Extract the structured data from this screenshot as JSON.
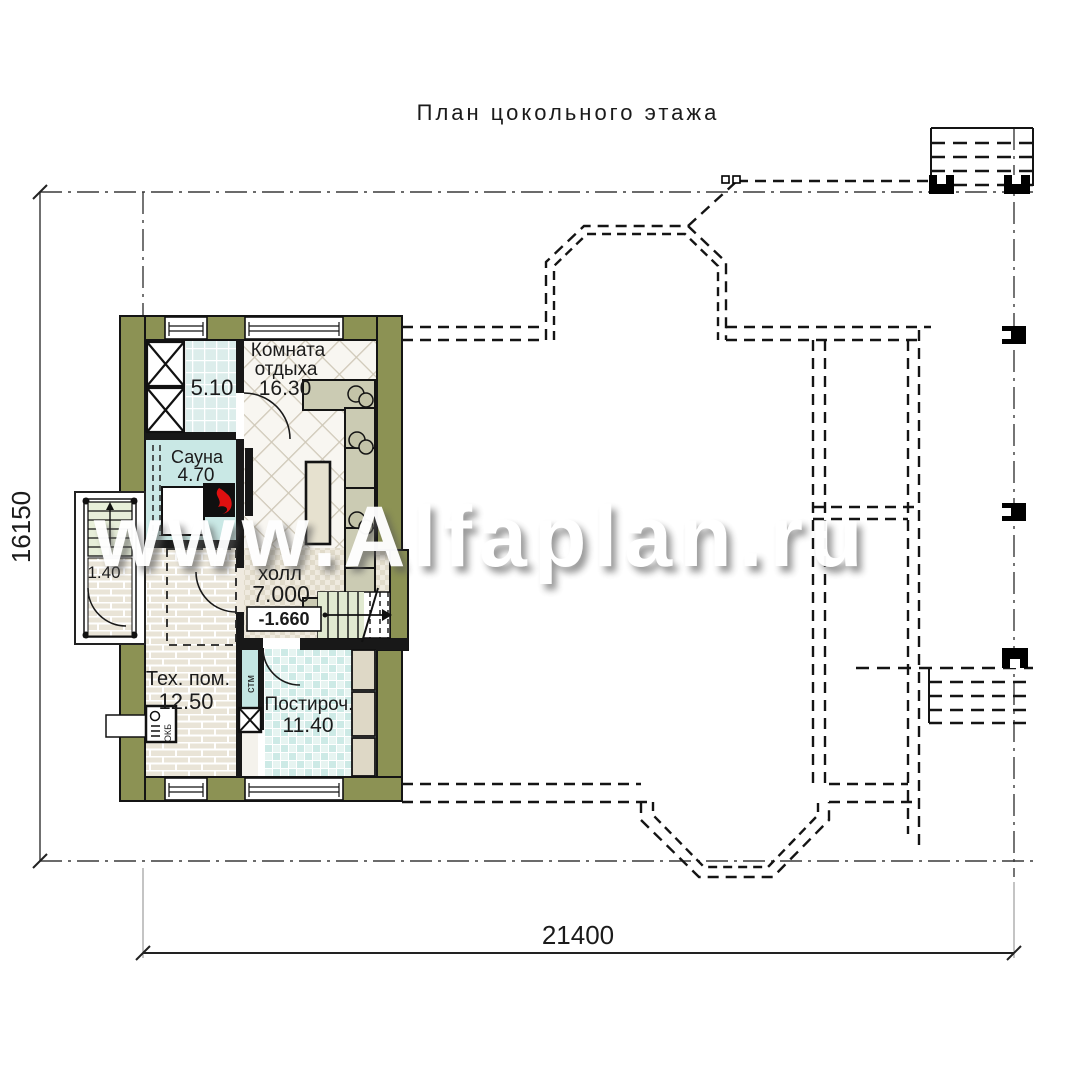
{
  "title": "План цокольного этажа",
  "watermark": "www.Alfaplan.ru",
  "dimensions": {
    "bottom": "21400",
    "left": "16150"
  },
  "rooms": {
    "storage": {
      "area": "5.10"
    },
    "lounge": {
      "name_line1": "Комната",
      "name_line2": "отдыха",
      "area": "16.30"
    },
    "sauna": {
      "name": "Сауна",
      "area": "4.70"
    },
    "entry": {
      "area": "1.40"
    },
    "hall": {
      "name": "холл",
      "area": "7.000",
      "level": "-1.660"
    },
    "tech": {
      "name": "Тех. пом.",
      "area": "12.50"
    },
    "laundry": {
      "name": "Постироч.",
      "area": "11.40"
    }
  },
  "equipment": {
    "washing_machine": "стм",
    "boiler": "ОКБ"
  },
  "colors": {
    "wall_olive": "#8c9254",
    "sauna_aqua": "#c9e8e5",
    "stove_red": "#e01010"
  }
}
